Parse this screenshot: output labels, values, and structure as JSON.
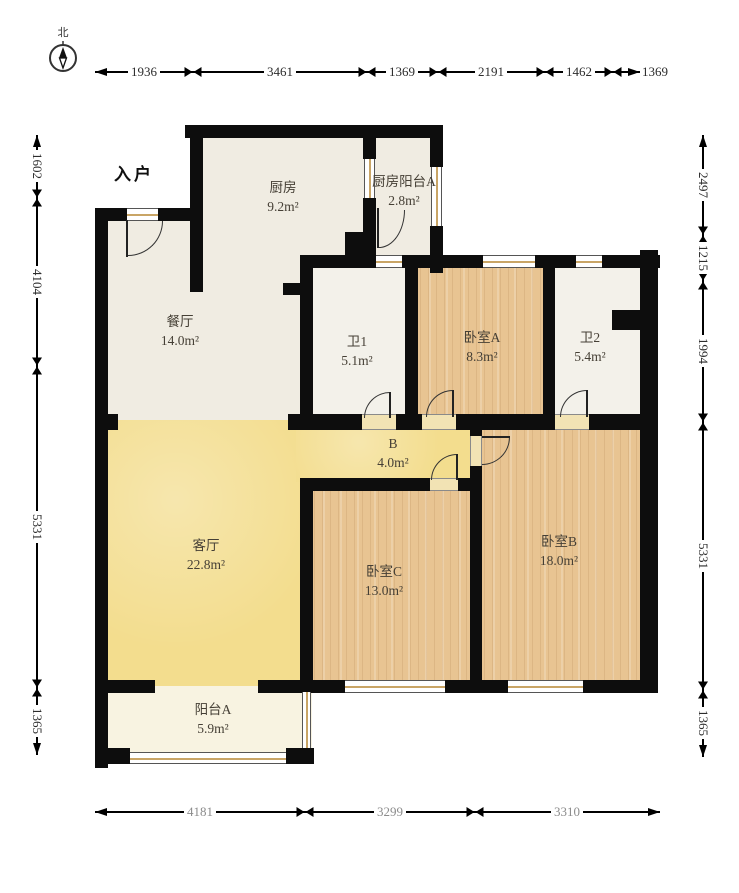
{
  "compass": {
    "north": "北"
  },
  "plan": {
    "entry_label": "入户"
  },
  "rooms": {
    "kitchen": {
      "name": "厨房",
      "area": "9.2m²"
    },
    "kitchen_balcony": {
      "name": "厨房阳台A",
      "area": "2.8m²"
    },
    "dining": {
      "name": "餐厅",
      "area": "14.0m²"
    },
    "bath1": {
      "name": "卫1",
      "area": "5.1m²"
    },
    "bedroom_a": {
      "name": "卧室A",
      "area": "8.3m²"
    },
    "bath2": {
      "name": "卫2",
      "area": "5.4m²"
    },
    "hallway": {
      "name": "B",
      "area": "4.0m²"
    },
    "living": {
      "name": "客厅",
      "area": "22.8m²"
    },
    "bedroom_c": {
      "name": "卧室C",
      "area": "13.0m²"
    },
    "bedroom_b": {
      "name": "卧室B",
      "area": "18.0m²"
    },
    "balcony_a": {
      "name": "阳台A",
      "area": "5.9m²"
    }
  },
  "dimensions": {
    "top": [
      "1936",
      "3461",
      "1369",
      "2191",
      "1462",
      "1369"
    ],
    "bottom": [
      "4181",
      "3299",
      "3310"
    ],
    "left": [
      "1602",
      "4104",
      "5331",
      "1365"
    ],
    "right": [
      "2497",
      "1215",
      "1994",
      "5331",
      "1365"
    ]
  },
  "colors": {
    "wall": "#0d0d0d",
    "living_yellow": "#f3dd8e",
    "bedroom_wood": "#e8c492",
    "kitchen_cream": "#f0ece2",
    "balcony_cream": "#f8f3e1"
  }
}
